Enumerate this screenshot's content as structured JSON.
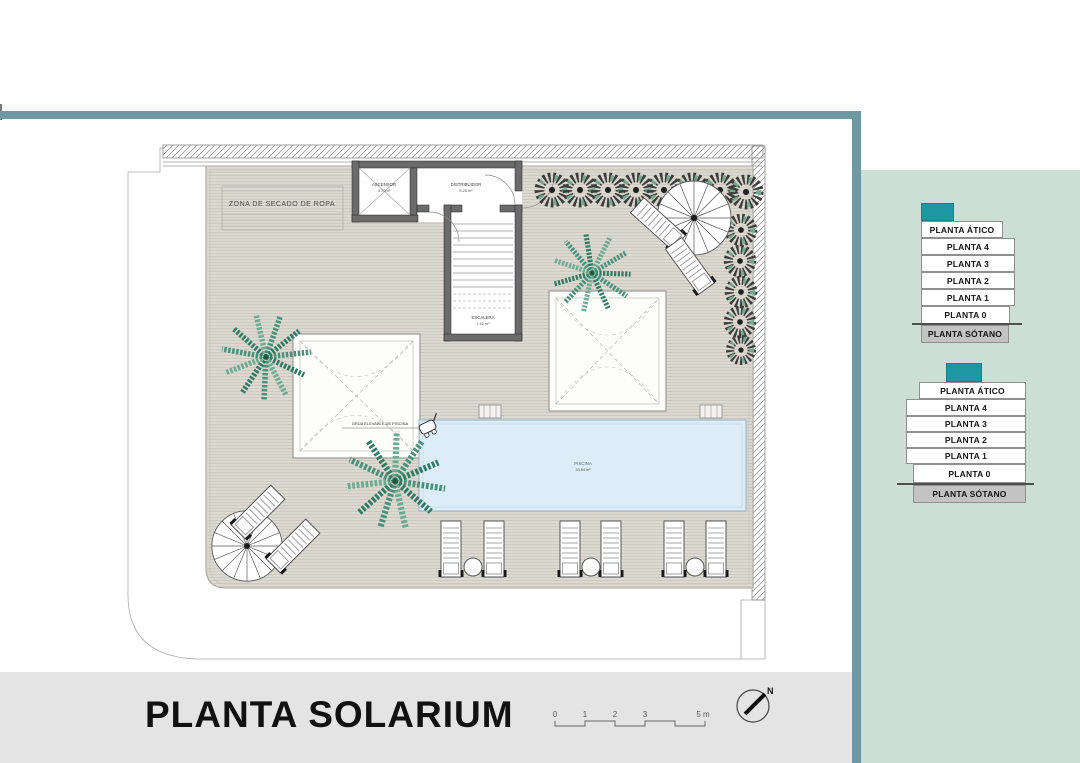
{
  "plan": {
    "title": "PLANTA SOLARIUM",
    "labels": {
      "zona_secado": "ZONA DE SECADO DE ROPA",
      "ascensor": "ASCENSOR",
      "ascensor_area": "3.72m²",
      "distribuidor": "DISTRIBUIDOR",
      "distribuidor_area": "5.26 m²",
      "escalera": "ESCALERA",
      "escalera_area": "7.92 m²",
      "piscina": "PISCINA",
      "piscina_area": "33.64 m²",
      "grua": "GRÚA ELEVABLE DE PISCINA"
    },
    "scale_ticks": [
      "0",
      "1",
      "2",
      "3",
      "5 m"
    ],
    "north": "N"
  },
  "floor_selector": {
    "block_a": {
      "floors": [
        "PLANTA ÁTICO",
        "PLANTA 4",
        "PLANTA 3",
        "PLANTA 2",
        "PLANTA 1",
        "PLANTA 0",
        "PLANTA SÓTANO"
      ]
    },
    "block_b": {
      "floors": [
        "PLANTA ÁTICO",
        "PLANTA 4",
        "PLANTA 3",
        "PLANTA 2",
        "PLANTA 1",
        "PLANTA 0",
        "PLANTA SÓTANO"
      ]
    }
  },
  "colors": {
    "frame_teal": "#6f98a2",
    "accent_teal": "#1d98a2",
    "panel_mint": "#cbdfd6",
    "band_gray": "#e4e4e4",
    "deck": "#dcd9d1",
    "pool": "#dcedf8"
  }
}
